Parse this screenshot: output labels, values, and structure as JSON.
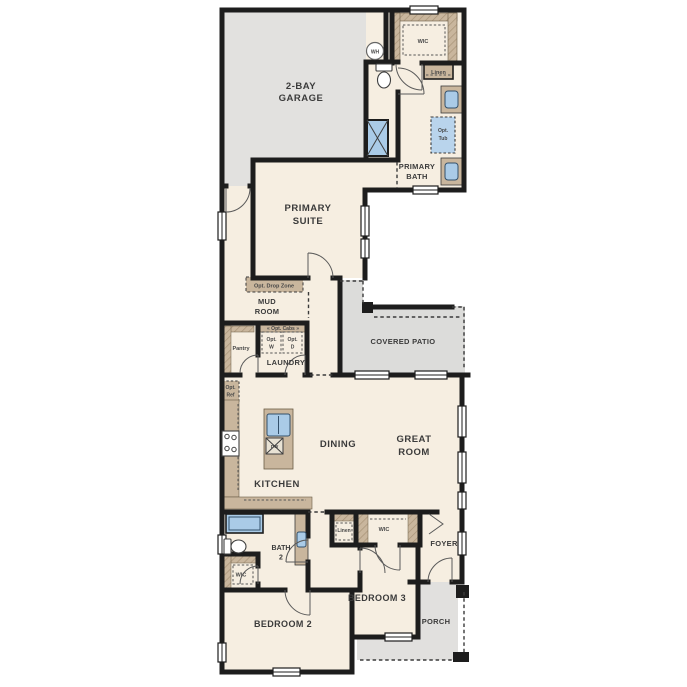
{
  "rooms": {
    "garage": {
      "l1": "2-BAY",
      "l2": "GARAGE"
    },
    "primary_suite": {
      "l1": "PRIMARY",
      "l2": "SUITE"
    },
    "primary_bath": {
      "l1": "PRIMARY",
      "l2": "BATH"
    },
    "wic_primary": {
      "l1": "WIC"
    },
    "mud_room": {
      "l1": "MUD",
      "l2": "ROOM"
    },
    "pantry": {
      "l1": "Pantry"
    },
    "laundry": {
      "l1": "LAUNDRY"
    },
    "covered_patio": {
      "l1": "COVERED PATIO"
    },
    "kitchen": {
      "l1": "KITCHEN"
    },
    "dining": {
      "l1": "DINING"
    },
    "great_room": {
      "l1": "GREAT",
      "l2": "ROOM"
    },
    "bath2": {
      "l1": "BATH",
      "l2": "2"
    },
    "wic_bed2": {
      "l1": "WIC"
    },
    "wic_bed3": {
      "l1": "WIC"
    },
    "foyer": {
      "l1": "FOYER"
    },
    "bedroom2": {
      "l1": "BEDROOM 2"
    },
    "bedroom3": {
      "l1": "BEDROOM 3"
    },
    "porch": {
      "l1": "PORCH"
    }
  },
  "closets": {
    "linen_primary": "Linen",
    "linen_hall": "Linen"
  },
  "options": {
    "drop_zone": "Opt. Drop Zone",
    "cabs": "« Opt. Cabs »",
    "washer": {
      "l1": "Opt.",
      "l2": "W"
    },
    "dryer": {
      "l1": "Opt.",
      "l2": "D"
    },
    "ref": {
      "l1": "Opt.",
      "l2": "Ref"
    },
    "tub": {
      "l1": "Opt.",
      "l2": "Tub"
    }
  },
  "fixtures": {
    "water_heater": "WH",
    "dishwasher": "DW"
  },
  "colors": {
    "wall": "#1d1d1d",
    "interior": "#f6eee1",
    "garage": "#e2e1df",
    "patio": "#dcdcda",
    "porch": "#e1e0de",
    "cabinet": "#c9b69d",
    "fixture_blue": "#aacbe7",
    "label": "#3b3b3b"
  }
}
